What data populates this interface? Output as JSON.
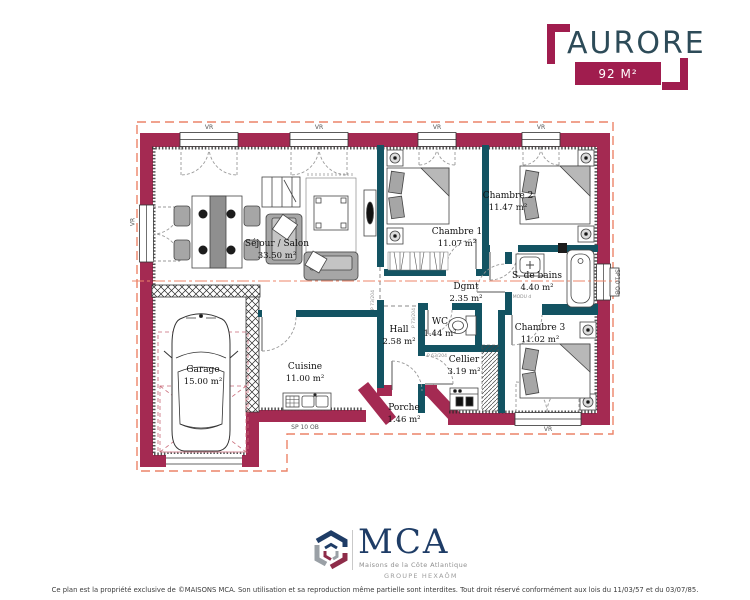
{
  "header": {
    "title": "AURORE",
    "area_badge": "92 M²"
  },
  "plan": {
    "rooms": [
      {
        "name": "Séjour / Salon",
        "area": "33.50 m²"
      },
      {
        "name": "Chambre 1",
        "area": "11.07 m²"
      },
      {
        "name": "Chambre 2",
        "area": "11.47 m²"
      },
      {
        "name": "S. de bains",
        "area": "4.40 m²"
      },
      {
        "name": "Dgmt",
        "area": "2.35 m²"
      },
      {
        "name": "WC",
        "area": "1.44 m²"
      },
      {
        "name": "Hall",
        "area": "2.58 m²"
      },
      {
        "name": "Cellier",
        "area": "3.19 m²"
      },
      {
        "name": "Cuisine",
        "area": "11.00 m²"
      },
      {
        "name": "Garage",
        "area": "15.00 m²"
      },
      {
        "name": "Chambre 3",
        "area": "11.02 m²"
      },
      {
        "name": "Porche",
        "area": "1.46 m²"
      }
    ],
    "window_labels": [
      {
        "text": "VR"
      },
      {
        "text": "VR"
      },
      {
        "text": "VR"
      },
      {
        "text": "VR"
      },
      {
        "text": "VR"
      },
      {
        "text": "SP10 OB"
      },
      {
        "text": "SP 10 OB"
      },
      {
        "text": "VR"
      }
    ],
    "door_labels": [
      {
        "text": "P 73/204"
      },
      {
        "text": "P 73/204"
      },
      {
        "text": "P 63/204"
      },
      {
        "text": "MODU d"
      }
    ]
  },
  "footer": {
    "brand": "MCA",
    "tagline": "Maisons de la Côte Atlantique",
    "group": "GROUPE HEXAÔM",
    "disclaimer": "Ce plan est la propriété exclusive de ©MAISONS MCA. Son utilisation et sa reproduction même partielle sont interdites. Tout droit réservé conformément aux lois du 11/03/57 et du 03/07/85."
  },
  "colors": {
    "exterior_wall": "#A42A52",
    "interior_wall": "#135362",
    "roof_dash": "#EC8468",
    "title_text": "#2D4B58",
    "badge": "#A01D4E",
    "logo_navy": "#1E3C66",
    "logo_gray": "#9AA0A6",
    "logo_burgundy": "#8E2C49"
  }
}
